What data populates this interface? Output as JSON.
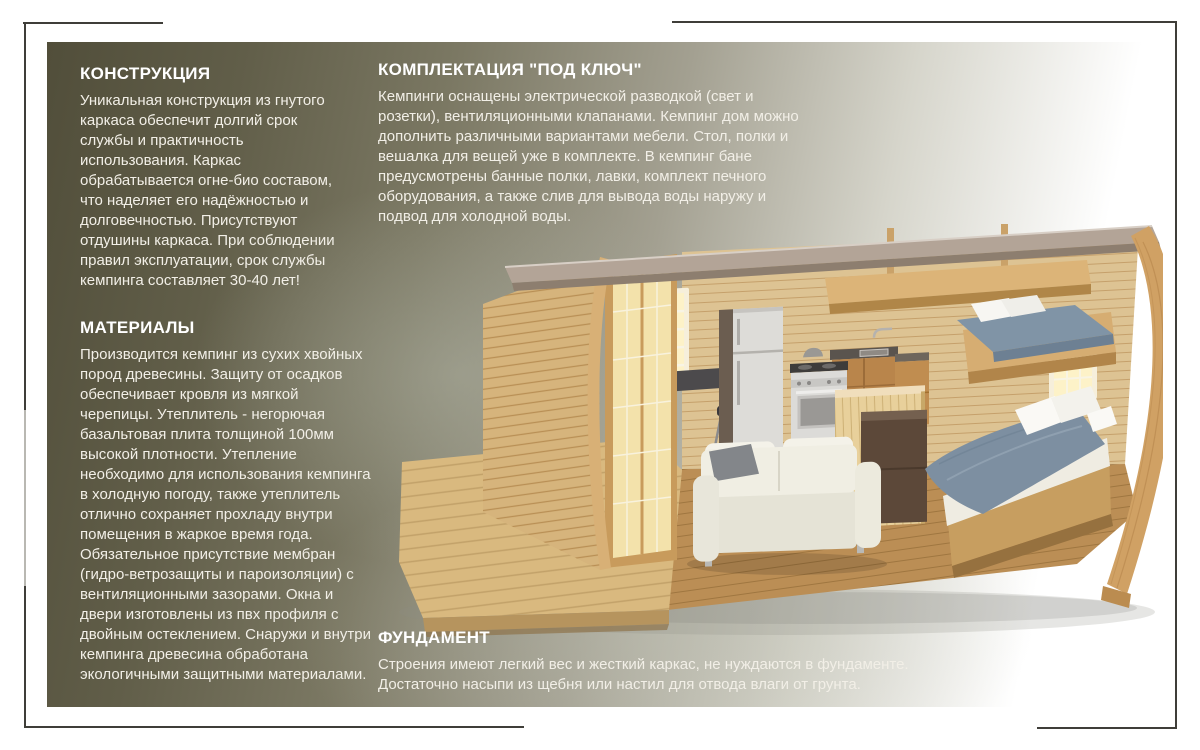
{
  "colors": {
    "page-bg": "#ffffff",
    "frame-line": "#3f3e39",
    "panel-dark": "#514e3a",
    "panel-mid": "#7b7863",
    "panel-sage": "#aeb1a2",
    "panel-white": "#ffffff",
    "heading": "#ffffff",
    "body-text": "#f2efe7"
  },
  "sections": {
    "construction": {
      "title": "КОНСТРУКЦИЯ",
      "body": "Уникальная конструкция из гнутого\nкаркаса обеспечит долгий срок\nслужбы и практичность\nиспользования. Каркас\nобрабатывается огне-био составом,\nчто наделяет его надёжностью и\nдолговечностью. Присутствуют\nотдушины каркаса. При соблюдении\nправил эксплуатации, срок службы\nкемпинга составляет 30-40 лет!"
    },
    "materials": {
      "title": "МАТЕРИАЛЫ",
      "body": "Производится кемпинг из сухих хвойных\nпород древесины. Защиту от осадков\nобеспечивает кровля из мягкой\nчерепицы.  Утеплитель - негорючая\nбазальтовая плита толщиной 100мм\nвысокой плотности. Утепление\nнеобходимо для использования кемпинга\nв холодную погоду, также утеплитель\nотлично сохраняет прохладу внутри\nпомещения в жаркое время года.\nОбязательное присутствие мембран\n(гидро-ветрозащиты и пароизоляции) с\nвентиляционными зазорами. Окна и\nдвери изготовлены из пвх профиля с\nдвойным остеклением. Снаружи и внутри\nкемпинга древесина обработана\nэкологичными  защитными материалами."
    },
    "equipment": {
      "title": "КОМПЛЕКТАЦИЯ \"ПОД КЛЮЧ\"",
      "body": "Кемпинги оснащены электрической разводкой (свет и\nрозетки), вентиляционными клапанами. Кемпинг дом можно\nдополнить различными вариантами мебели. Стол, полки и\nвешалка для вещей уже в комплекте. В кемпинг бане\nпредусмотрены банные полки, лавки, комплект печного\nоборудования, а также слив для вывода воды наружу и\nподвод для холодной воды."
    },
    "foundation": {
      "title": "ФУНДАМЕНТ",
      "body": "Строения имеют легкий вес и жесткий каркас, не нуждаются в фундаменте.\nДостаточно насыпи из щебня или настил для отвода влаги от грунта."
    }
  },
  "illustration": {
    "label": "camping-house-cutaway"
  }
}
